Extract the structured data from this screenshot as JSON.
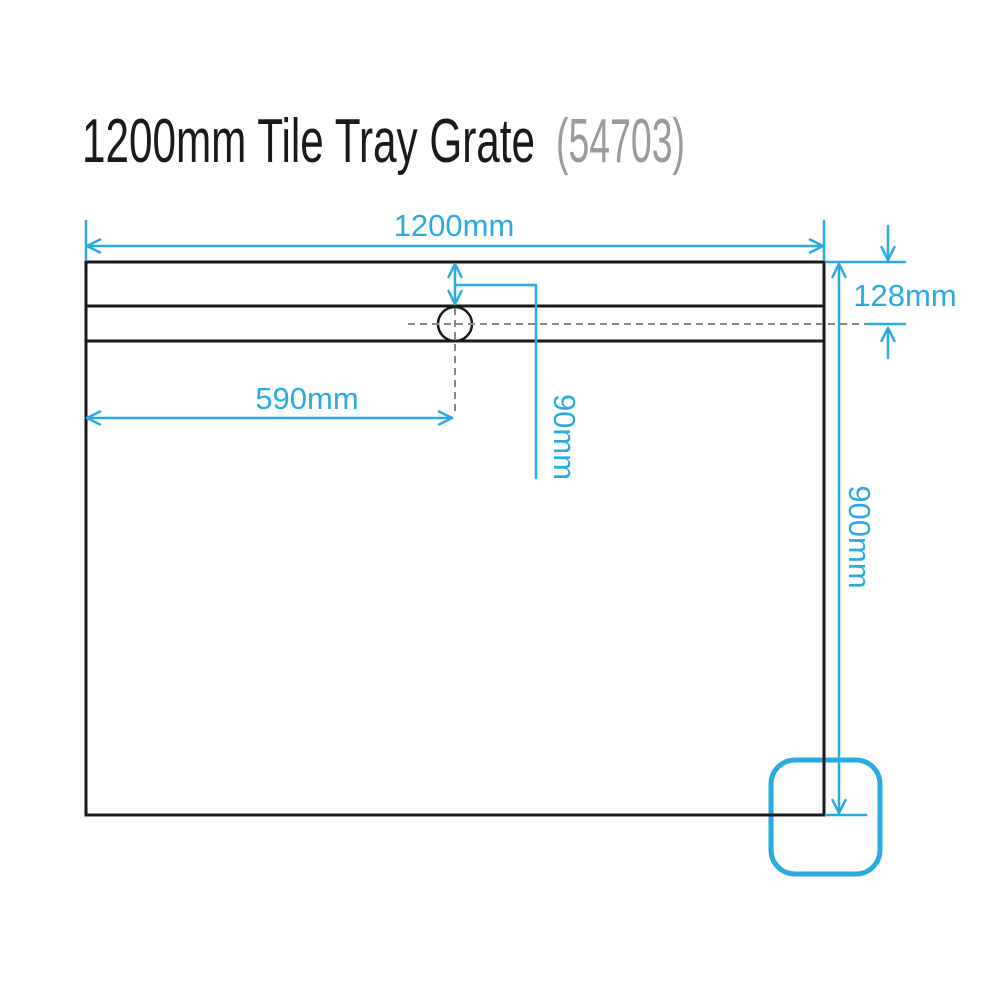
{
  "title": {
    "product": "1200mm Tile Tray Grate",
    "sku": "(54703)"
  },
  "colors": {
    "accent": "#29ABE2",
    "ink": "#1A1A1A",
    "muted": "#9B9B9B",
    "centerline": "#888888"
  },
  "dimensions": {
    "overall_width": "1200mm",
    "overall_depth": "900mm",
    "drain_centre_from_left": "590mm",
    "drain_centre_from_top": "128mm",
    "grate_offset": "90mm"
  }
}
